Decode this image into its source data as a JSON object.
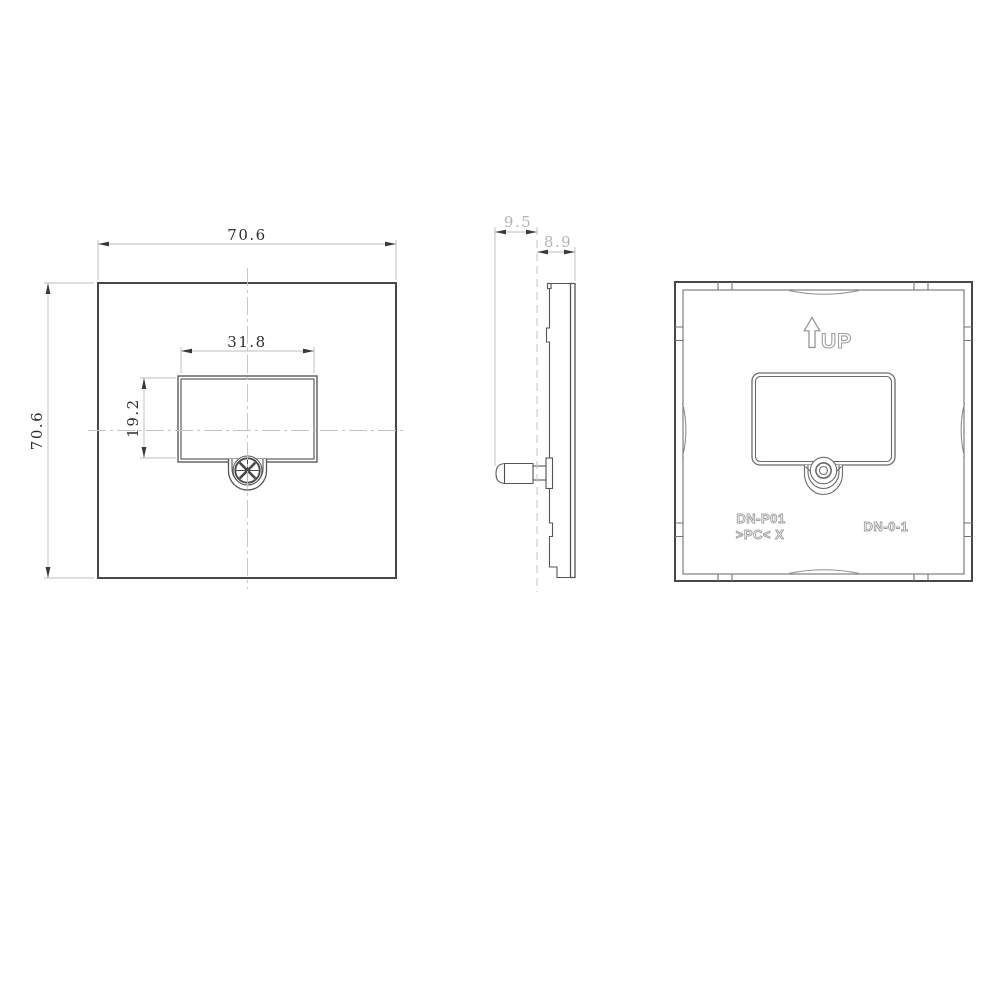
{
  "front_view": {
    "dim_width": "70.6",
    "dim_height": "70.6",
    "dim_opening_width": "31.8",
    "dim_opening_height": "19.2"
  },
  "side_view": {
    "dim_overall_depth": "9.5",
    "dim_body_depth": "8.9"
  },
  "back_view": {
    "orientation_label": "UP",
    "marking_model": "DN-P01",
    "marking_material": ">PC< X",
    "marking_code": "DN-0-1"
  },
  "colors": {
    "object_line": "#4f4f4f",
    "dimension_line": "#bcbcbc",
    "dimension_text_dark": "#2f2f2f",
    "dimension_text_light": "#b3b3b3",
    "molded_text": "#9e9e9e",
    "background": "#ffffff"
  }
}
